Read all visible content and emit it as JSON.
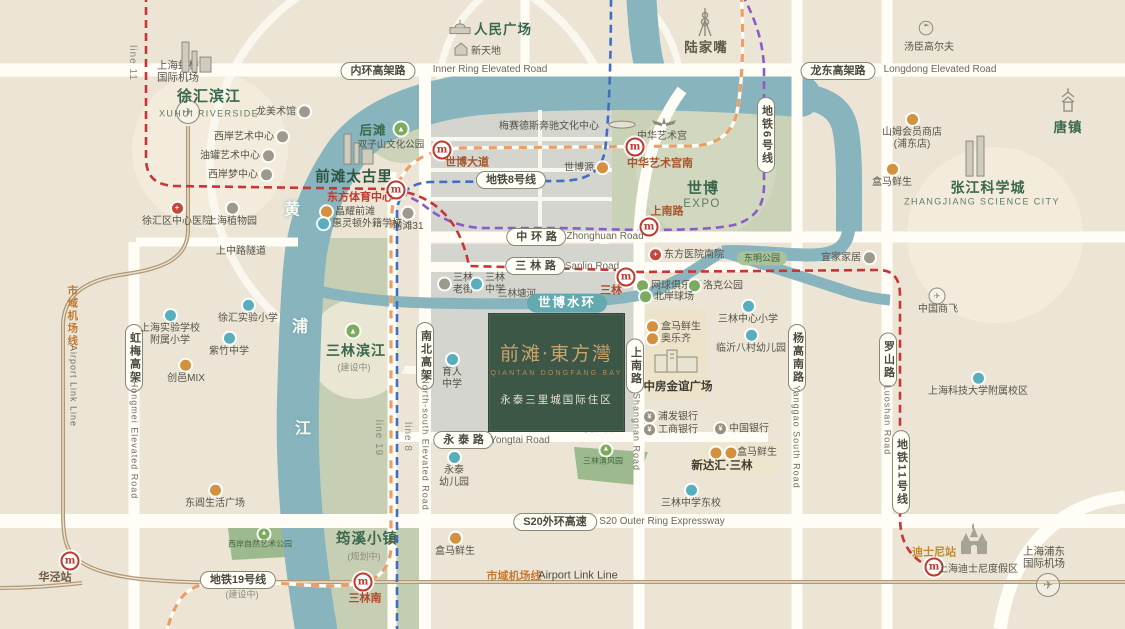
{
  "title": "前滩·東方灣 区位示意图",
  "project": {
    "title": "前滩·東方灣",
    "en": "QIANTAN DONGFANG BAY",
    "subtitle": "永泰三里城国际住区"
  },
  "colors": {
    "background": "#ece5d5",
    "river": "#87b4bd",
    "urban_block": "#d4d5ce",
    "green_area": "#c6cfb4",
    "project_block": "#3d5747",
    "project_gold": "#c8a36b",
    "metro_line8": "#3f6fc0",
    "metro_line6": "#8a5cc8",
    "metro_line11": "#c93434",
    "metro_line19": "#ec9e68",
    "airport_link": "#b19873",
    "road": "#fffdf6",
    "station_red": "#c0392f",
    "water_ring_pill": "#63a9ae"
  },
  "labels": [
    {
      "n": "label-hongqiao-airport",
      "k": "p",
      "t": "上海虹桥\n国际机场",
      "x": 178,
      "y": 72,
      "s": 10.5
    },
    {
      "n": "icon-hongqiao-plane",
      "k": "ic",
      "ic": "plane",
      "x": 188,
      "y": 112
    },
    {
      "n": "label-line-11",
      "k": "lin",
      "t": "line 11",
      "x": 132,
      "y": 63
    },
    {
      "n": "icon-xuhui-skyline",
      "k": "ic",
      "ic": "skyline",
      "x": 196,
      "y": 60
    },
    {
      "n": "label-xuhui-riverside",
      "k": "a",
      "t": "徐汇滨江",
      "x": 209,
      "y": 97,
      "s": 15
    },
    {
      "n": "label-xuhui-riverside-en",
      "k": "ae",
      "t": "XUHUI RIVERSIDE",
      "x": 209,
      "y": 114
    },
    {
      "n": "poi-long-museum",
      "k": "poi",
      "t": "龙美术馆",
      "dot": "gray",
      "side": "r",
      "x": 283,
      "y": 112
    },
    {
      "n": "poi-westbund-art-center",
      "k": "poi",
      "t": "西岸艺术中心",
      "dot": "gray",
      "side": "r",
      "x": 251,
      "y": 137
    },
    {
      "n": "poi-tank-art-center",
      "k": "poi",
      "t": "油罐艺术中心",
      "dot": "gray",
      "side": "r",
      "x": 237,
      "y": 156
    },
    {
      "n": "poi-westbund-dream-center",
      "k": "poi",
      "t": "西岸梦中心",
      "dot": "gray",
      "side": "r",
      "x": 240,
      "y": 175
    },
    {
      "n": "poi-xuhui-hospital",
      "k": "poi",
      "t": "徐汇区中心医院",
      "dot": "red",
      "g": "+",
      "side": "t",
      "x": 177,
      "y": 215
    },
    {
      "n": "poi-botanical-garden",
      "k": "poi",
      "t": "上海植物园",
      "dot": "gray",
      "side": "t",
      "x": 232,
      "y": 215
    },
    {
      "n": "river-char-huang",
      "k": "rc",
      "t": "黄",
      "x": 292,
      "y": 211
    },
    {
      "n": "river-char-pu",
      "k": "rc",
      "t": "浦",
      "x": 300,
      "y": 328
    },
    {
      "n": "river-char-jiang",
      "k": "rc",
      "t": "江",
      "x": 303,
      "y": 430
    },
    {
      "n": "icon-peoples-square",
      "k": "ic",
      "ic": "dome",
      "x": 460,
      "y": 29
    },
    {
      "n": "label-peoples-square",
      "k": "a",
      "t": "人民广场",
      "x": 503,
      "y": 30,
      "s": 13.5
    },
    {
      "n": "icon-xintiandi",
      "k": "ic",
      "ic": "house",
      "x": 461,
      "y": 52
    },
    {
      "n": "poi-xintiandi",
      "k": "p",
      "t": "新天地",
      "x": 486,
      "y": 52
    },
    {
      "n": "pill-inner-ring",
      "k": "pill",
      "t": "内环高架路",
      "x": 378,
      "y": 71
    },
    {
      "n": "label-inner-ring-en",
      "k": "enh",
      "t": "Inner Ring Elevated Road",
      "x": 490,
      "y": 70
    },
    {
      "n": "label-mercedes-arena",
      "k": "p",
      "t": "梅赛德斯奔驰文化中心",
      "x": 549,
      "y": 127
    },
    {
      "n": "icon-mercedes-arena",
      "k": "ic",
      "ic": "arena",
      "x": 622,
      "y": 126
    },
    {
      "n": "label-houtan",
      "k": "a",
      "t": "后滩",
      "x": 373,
      "y": 131,
      "s": 12.5
    },
    {
      "n": "icon-houtan-park",
      "k": "ic",
      "ic": "park",
      "x": 401,
      "y": 129
    },
    {
      "n": "label-shuangzishan-park",
      "k": "p",
      "t": "双子山文化公园",
      "x": 391,
      "y": 145,
      "s": 9.5
    },
    {
      "n": "icon-taikoo-skyline",
      "k": "ic",
      "ic": "skyline",
      "x": 358,
      "y": 152
    },
    {
      "n": "label-qiantan-taikoo-li",
      "k": "a",
      "t": "前滩太古里",
      "x": 354,
      "y": 178,
      "s": 14.5,
      "c": "#2e5743"
    },
    {
      "n": "station-dongfang-sports-center",
      "k": "st",
      "t": "东方体育中心",
      "ix": 396,
      "iy": 190,
      "lx": 360,
      "ly": 198,
      "c": "#c03a31"
    },
    {
      "n": "poi-jingyao-qiantan",
      "k": "poi",
      "t": "晶耀前滩",
      "dot": "orange",
      "side": "l",
      "x": 348,
      "y": 212
    },
    {
      "n": "poi-wellington-school",
      "k": "poi",
      "t": "惠灵顿外籍学校",
      "dot": "teal",
      "side": "l",
      "x": 360,
      "y": 224
    },
    {
      "n": "poi-qiantan-31",
      "k": "poi",
      "t": "前滩31",
      "dot": "gray",
      "side": "t",
      "x": 408,
      "y": 220
    },
    {
      "n": "station-expo-avenue",
      "k": "st",
      "t": "世博大道",
      "ix": 442,
      "iy": 150,
      "lx": 467,
      "ly": 163,
      "c": "#a6572c"
    },
    {
      "n": "pill-metro-line-8",
      "k": "pill",
      "t": "地铁8号线",
      "x": 511,
      "y": 180
    },
    {
      "n": "poi-expo-source",
      "k": "poi",
      "t": "世博源",
      "dot": "orange",
      "side": "r",
      "x": 586,
      "y": 168
    },
    {
      "n": "icon-lujiazui-tower",
      "k": "ic",
      "ic": "tvtower",
      "x": 705,
      "y": 25
    },
    {
      "n": "label-lujiazui",
      "k": "a",
      "t": "陆家嘴",
      "x": 706,
      "y": 48,
      "s": 13.5,
      "c": "#5e5b45"
    },
    {
      "n": "icon-art-palace",
      "k": "ic",
      "ic": "wings",
      "x": 664,
      "y": 125
    },
    {
      "n": "label-art-palace",
      "k": "p",
      "t": "中华艺术宫",
      "x": 662,
      "y": 137
    },
    {
      "n": "station-art-palace-south",
      "k": "st",
      "t": "中华艺术宫南",
      "ix": 635,
      "iy": 147,
      "lx": 660,
      "ly": 164,
      "c": "#a6572c"
    },
    {
      "n": "label-expo",
      "k": "a",
      "t": "世博",
      "x": 703,
      "y": 189,
      "s": 15
    },
    {
      "n": "label-expo-en",
      "k": "ae",
      "t": "EXPO",
      "x": 702,
      "y": 205,
      "s": 11.5
    },
    {
      "n": "station-shangnan-road",
      "k": "st",
      "t": "上南路",
      "ix": 649,
      "iy": 227,
      "lx": 667,
      "ly": 212,
      "c": "#a6572c"
    },
    {
      "n": "pill-metro-line-6",
      "k": "vpill",
      "t": "地铁6号线",
      "x": 766,
      "y": 135
    },
    {
      "n": "pill-longdong-elevated",
      "k": "pill",
      "t": "龙东高架路",
      "x": 838,
      "y": 71
    },
    {
      "n": "label-longdong-en",
      "k": "enh",
      "t": "Longdong Elevated Road",
      "x": 940,
      "y": 70
    },
    {
      "n": "icon-tomson-golf",
      "k": "ic",
      "ic": "golf",
      "x": 926,
      "y": 31
    },
    {
      "n": "poi-tomson-golf",
      "k": "p",
      "t": "汤臣高尔夫",
      "x": 929,
      "y": 48
    },
    {
      "n": "poi-sams-club",
      "k": "poi",
      "t": "山姆会员商店\n(浦东店)",
      "dot": "orange",
      "side": "t",
      "x": 912,
      "y": 132
    },
    {
      "n": "poi-hema-northeast",
      "k": "poi",
      "t": "盒马鲜生",
      "dot": "orange",
      "side": "t",
      "x": 892,
      "y": 176
    },
    {
      "n": "icon-tangzhen-pagoda",
      "k": "ic",
      "ic": "pagoda",
      "x": 1068,
      "y": 103
    },
    {
      "n": "label-tangzhen",
      "k": "a",
      "t": "唐镇",
      "x": 1068,
      "y": 128,
      "s": 13.5
    },
    {
      "n": "icon-zhangjiang-towers",
      "k": "ic",
      "ic": "towers",
      "x": 975,
      "y": 159
    },
    {
      "n": "label-zhangjiang",
      "k": "a",
      "t": "张江科学城",
      "x": 988,
      "y": 188,
      "s": 14
    },
    {
      "n": "label-zhangjiang-en",
      "k": "ae",
      "t": "ZHANGJIANG SCIENCE CITY",
      "x": 982,
      "y": 202
    },
    {
      "n": "label-airport-link-cn-v",
      "k": "vor",
      "t": "市域机场线",
      "x": 72,
      "y": 316
    },
    {
      "n": "label-airport-link-en-v",
      "k": "ven",
      "t": "Airport Link Line",
      "x": 73,
      "y": 386
    },
    {
      "n": "pill-hongmei-elevated",
      "k": "vpill",
      "t": "虹梅高架",
      "x": 134,
      "y": 358
    },
    {
      "n": "label-hongmei-en-v",
      "k": "ven",
      "t": "Hongmei Elevated Road",
      "x": 134,
      "y": 440
    },
    {
      "n": "label-shangzhong-tunnel",
      "k": "p",
      "t": "上中路隧道",
      "x": 241,
      "y": 252
    },
    {
      "n": "poi-shiyan-primary",
      "k": "poi",
      "t": "上海实验学校\n附属小学",
      "dot": "teal",
      "side": "t",
      "x": 170,
      "y": 328
    },
    {
      "n": "poi-xuhui-exp-primary",
      "k": "poi",
      "t": "徐汇实验小学",
      "dot": "teal",
      "side": "t",
      "x": 248,
      "y": 312
    },
    {
      "n": "poi-zizhu-middle",
      "k": "poi",
      "t": "紫竹中学",
      "dot": "teal",
      "side": "t",
      "x": 229,
      "y": 345
    },
    {
      "n": "poi-chuangyi-mix",
      "k": "poi",
      "t": "创邑MIX",
      "dot": "orange",
      "side": "t",
      "x": 186,
      "y": 372
    },
    {
      "n": "icon-sanlin-riverside-park",
      "k": "ic",
      "ic": "park",
      "x": 353,
      "y": 331
    },
    {
      "n": "label-sanlin-riverside",
      "k": "a",
      "t": "三林滨江",
      "x": 356,
      "y": 351,
      "s": 14
    },
    {
      "n": "note-sanlin-riverside",
      "k": "note",
      "t": "(建设中)",
      "x": 354,
      "y": 368
    },
    {
      "n": "label-line-19",
      "k": "lin",
      "t": "line 19",
      "x": 378,
      "y": 438
    },
    {
      "n": "label-line-8",
      "k": "lin",
      "t": "line 8",
      "x": 407,
      "y": 437
    },
    {
      "n": "pill-north-south-elevated",
      "k": "vpill",
      "t": "南北高架",
      "x": 425,
      "y": 356
    },
    {
      "n": "label-north-south-en-v",
      "k": "ven",
      "t": "North-south Elevated Road",
      "x": 425,
      "y": 444
    },
    {
      "n": "poi-yuren-middle",
      "k": "poi",
      "t": "育人\n中学",
      "dot": "teal",
      "side": "t",
      "x": 452,
      "y": 372
    },
    {
      "n": "pill-zhonghuan-road",
      "k": "pill",
      "t": "中环路",
      "sp": 1,
      "x": 536,
      "y": 237
    },
    {
      "n": "label-zhonghuan-en",
      "k": "enh",
      "t": "Zhonghuan Road",
      "x": 605,
      "y": 237
    },
    {
      "n": "pill-sanlin-road",
      "k": "pill",
      "t": "三林路",
      "sp": 1,
      "x": 535,
      "y": 266
    },
    {
      "n": "label-sanlin-road-en",
      "k": "enh",
      "t": "Sanlin Road",
      "x": 592,
      "y": 267
    },
    {
      "n": "poi-sanlin-old-street",
      "k": "poi",
      "t": "三林\n老街",
      "dot": "gray",
      "side": "l",
      "x": 456,
      "y": 284
    },
    {
      "n": "poi-sanlin-middle",
      "k": "poi",
      "t": "三林\n中学",
      "dot": "teal",
      "side": "l",
      "x": 488,
      "y": 284
    },
    {
      "n": "label-sanlin-tanghe",
      "k": "p",
      "t": "三林塘河",
      "x": 517,
      "y": 294,
      "s": 9.5
    },
    {
      "n": "pill-expo-water-ring",
      "k": "tpill",
      "t": "世博水环",
      "x": 567,
      "y": 303
    },
    {
      "n": "station-sanlin",
      "k": "st",
      "t": "三林",
      "ix": 626,
      "iy": 277,
      "lx": 611,
      "ly": 291,
      "c": "#b04a2a"
    },
    {
      "n": "poi-dongfang-hospital-south",
      "k": "poi",
      "t": "东方医院南院",
      "dot": "red",
      "g": "+",
      "side": "l",
      "x": 687,
      "y": 255
    },
    {
      "n": "pill-dongming-park",
      "k": "gpill",
      "t": "东明公园",
      "x": 762,
      "y": 258
    },
    {
      "n": "poi-ikea",
      "k": "poi",
      "t": "宜家家居",
      "dot": "gray",
      "side": "r",
      "x": 848,
      "y": 258
    },
    {
      "n": "poi-tennis-club",
      "k": "poi",
      "t": "网球俱乐部",
      "dot": "green",
      "side": "l",
      "x": 669,
      "y": 286
    },
    {
      "n": "poi-rock-park",
      "k": "poi",
      "t": "洛克公园",
      "dot": "green",
      "side": "l",
      "x": 716,
      "y": 286
    },
    {
      "n": "poi-beian-court",
      "k": "poi",
      "t": "北岸球场",
      "dot": "green",
      "side": "l",
      "x": 667,
      "y": 297
    },
    {
      "n": "poi-sanlin-center-primary",
      "k": "poi",
      "t": "三林中心小学",
      "dot": "teal",
      "side": "t",
      "x": 748,
      "y": 313
    },
    {
      "n": "poi-hema-center",
      "k": "poi",
      "t": "盒马鲜生",
      "dot": "orange",
      "side": "l",
      "x": 674,
      "y": 327
    },
    {
      "n": "poi-aldi",
      "k": "poi",
      "t": "奥乐齐",
      "dot": "orange",
      "side": "l",
      "x": 669,
      "y": 339
    },
    {
      "n": "poi-linyi-kindergarten",
      "k": "poi",
      "t": "临沂八村幼儿园",
      "dot": "teal",
      "side": "t",
      "x": 751,
      "y": 342
    },
    {
      "n": "icon-jinyi-mall",
      "k": "ic",
      "ic": "mall",
      "x": 676,
      "y": 363
    },
    {
      "n": "label-jinyi-plaza",
      "k": "bd",
      "t": "中房金谊广场",
      "x": 678,
      "y": 388
    },
    {
      "n": "pill-shangnan-v",
      "k": "vpill",
      "t": "上南路",
      "x": 635,
      "y": 366
    },
    {
      "n": "label-shangnan-en-v",
      "k": "ven",
      "t": "Shangnan Road",
      "x": 636,
      "y": 432
    },
    {
      "n": "pill-yanggao-south",
      "k": "vpill",
      "t": "杨高南路",
      "x": 797,
      "y": 358
    },
    {
      "n": "label-yanggao-en-v",
      "k": "ven",
      "t": "Yanggao South Road",
      "x": 796,
      "y": 437
    },
    {
      "n": "pill-luoshan-road",
      "k": "vpill",
      "t": "罗山路",
      "x": 888,
      "y": 360
    },
    {
      "n": "label-luoshan-en-v",
      "k": "ven",
      "t": "Luoshan Road",
      "x": 887,
      "y": 420
    },
    {
      "n": "icon-comac-plane",
      "k": "ic",
      "ic": "plane-sm",
      "x": 937,
      "y": 296
    },
    {
      "n": "poi-comac",
      "k": "p",
      "t": "中国商飞",
      "x": 938,
      "y": 310
    },
    {
      "n": "poi-shanghaitech",
      "k": "poi",
      "t": "上海科技大学附属校区",
      "dot": "teal",
      "side": "t",
      "x": 978,
      "y": 385
    },
    {
      "n": "pill-metro-line-11",
      "k": "vpill",
      "t": "地铁11号线",
      "x": 901,
      "y": 472
    },
    {
      "n": "poi-spd-bank",
      "k": "poi",
      "t": "浦发银行",
      "dot": "bank",
      "g": "¥",
      "side": "l",
      "x": 671,
      "y": 417
    },
    {
      "n": "poi-icbc-bank",
      "k": "poi",
      "t": "工商银行",
      "dot": "bank",
      "g": "¥",
      "side": "l",
      "x": 671,
      "y": 430
    },
    {
      "n": "poi-boc-bank",
      "k": "poi",
      "t": "中国银行",
      "dot": "bank",
      "g": "¥",
      "side": "l",
      "x": 742,
      "y": 429
    },
    {
      "n": "dot-xindahui-1",
      "k": "dot",
      "dot": "orange",
      "x": 716,
      "y": 453
    },
    {
      "n": "dot-xindahui-2",
      "k": "dot",
      "dot": "orange",
      "x": 731,
      "y": 453
    },
    {
      "n": "poi-hema-xindahui",
      "k": "p",
      "t": "盒马鲜生",
      "x": 757,
      "y": 453
    },
    {
      "n": "label-xindahui-sanlin",
      "k": "bd",
      "t": "新达汇·三林",
      "x": 722,
      "y": 467
    },
    {
      "n": "pill-yongtai-road",
      "k": "pill",
      "t": "永泰路",
      "sp": 1,
      "x": 463,
      "y": 440
    },
    {
      "n": "label-yongtai-en",
      "k": "enh",
      "t": "Yongtai Road",
      "x": 520,
      "y": 441
    },
    {
      "n": "poi-yongtai-kindergarten",
      "k": "poi",
      "t": "永泰\n幼儿园",
      "dot": "teal",
      "side": "t",
      "x": 454,
      "y": 470
    },
    {
      "n": "icon-luzhou-park",
      "k": "ic",
      "ic": "park-sm",
      "x": 616,
      "y": 419
    },
    {
      "n": "label-luzhou-park",
      "k": "parkl",
      "t": "绿轴公园",
      "x": 597,
      "y": 429
    },
    {
      "n": "icon-qingfeng-park",
      "k": "ic",
      "ic": "park-sm",
      "x": 606,
      "y": 450
    },
    {
      "n": "label-qingfeng-park",
      "k": "parkl",
      "t": "三林清风园",
      "x": 603,
      "y": 461
    },
    {
      "n": "pill-s20",
      "k": "pill",
      "t": "S20外环高速",
      "x": 555,
      "y": 522
    },
    {
      "n": "label-s20-en",
      "k": "enh",
      "t": "S20 Outer Ring Expressway",
      "x": 662,
      "y": 522
    },
    {
      "n": "poi-hema-south",
      "k": "poi",
      "t": "盒马鲜生",
      "dot": "orange",
      "side": "t",
      "x": 455,
      "y": 545
    },
    {
      "n": "poi-sanlin-middle-east",
      "k": "poi",
      "t": "三林中学东校",
      "dot": "teal",
      "side": "t",
      "x": 691,
      "y": 497
    },
    {
      "n": "label-airport-link-cn-h",
      "k": "orh",
      "t": "市域机场线",
      "x": 514,
      "y": 577
    },
    {
      "n": "label-airport-link-en-h",
      "k": "enh",
      "t": "Airport Link Line",
      "x": 578,
      "y": 576,
      "c": "#4e4b42",
      "s": 11
    },
    {
      "n": "poi-dongchang-plaza",
      "k": "poi",
      "t": "东阊生活广场",
      "dot": "orange",
      "side": "t",
      "x": 215,
      "y": 497
    },
    {
      "n": "icon-nature-park",
      "k": "ic",
      "ic": "park-sm",
      "x": 264,
      "y": 534
    },
    {
      "n": "label-nature-art-park",
      "k": "parkl",
      "t": "西岸自然艺术公园",
      "x": 260,
      "y": 544
    },
    {
      "n": "label-junxi-town",
      "k": "a",
      "t": "筠溪小镇",
      "x": 367,
      "y": 540,
      "s": 14.5
    },
    {
      "n": "note-junxi",
      "k": "note",
      "t": "(规划中)",
      "x": 364,
      "y": 557
    },
    {
      "n": "station-huajing",
      "k": "st",
      "t": "华泾站",
      "ix": 70,
      "iy": 561,
      "lx": 55,
      "ly": 578,
      "c": "#6e5a40"
    },
    {
      "n": "pill-metro-line-19",
      "k": "pill",
      "t": "地铁19号线",
      "x": 238,
      "y": 580
    },
    {
      "n": "note-line19",
      "k": "note",
      "t": "(建设中)",
      "x": 242,
      "y": 595
    },
    {
      "n": "station-sanlin-south",
      "k": "st",
      "t": "三林南",
      "ix": 363,
      "iy": 582,
      "lx": 365,
      "ly": 599,
      "c": "#b04a2a"
    },
    {
      "n": "station-disney",
      "k": "st",
      "t": "迪士尼站",
      "ix": 934,
      "iy": 567,
      "lx": 934,
      "ly": 553,
      "c": "#c08b2d"
    },
    {
      "n": "icon-disney-castle",
      "k": "ic",
      "ic": "castle",
      "x": 974,
      "y": 542
    },
    {
      "n": "poi-disney-resort",
      "k": "p",
      "t": "上海迪士尼度假区",
      "x": 978,
      "y": 570
    },
    {
      "n": "label-pudong-airport",
      "k": "p",
      "t": "上海浦东\n国际机场",
      "x": 1044,
      "y": 558,
      "s": 10.5
    },
    {
      "n": "icon-pudong-plane",
      "k": "ic",
      "ic": "plane",
      "x": 1048,
      "y": 585
    }
  ]
}
